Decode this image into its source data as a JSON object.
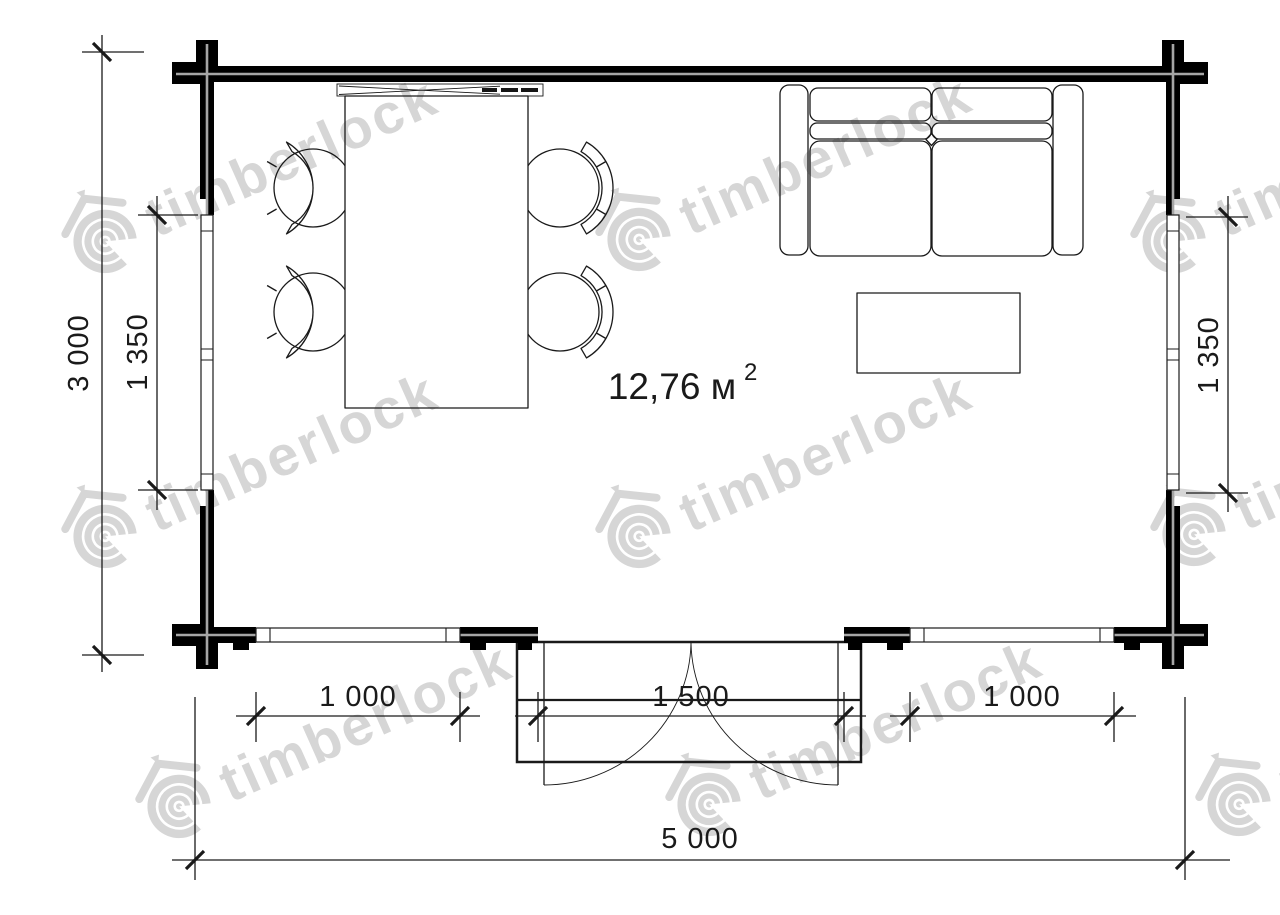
{
  "watermark": {
    "brand": "timberlock",
    "color": "#d6d6d6"
  },
  "plan": {
    "area": {
      "value": "12,76 м",
      "sup": "2"
    },
    "dimensions": {
      "depth": "3 000",
      "left_window": "1 350",
      "right_window": "1 350",
      "front_left_window": "1 000",
      "door": "1 500",
      "front_right_window": "1 000",
      "width": "5 000"
    },
    "colors": {
      "wall": "#000000",
      "line": "#1a1a1a",
      "centerline": "#a6a6a6"
    }
  }
}
